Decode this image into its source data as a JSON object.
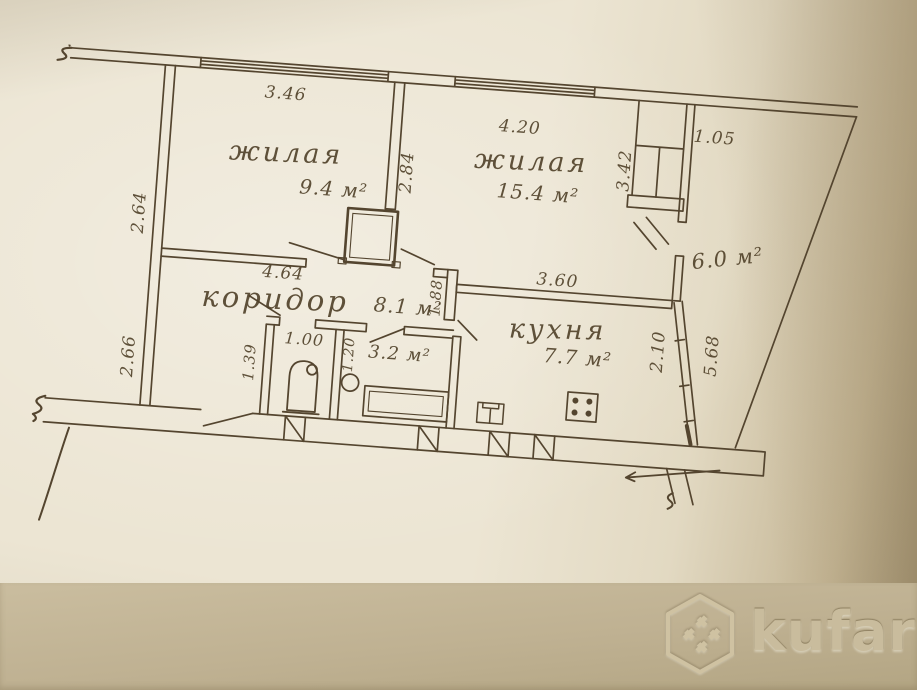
{
  "document_type": "apartment floor plan (hand-drawn, photographed)",
  "plan": {
    "rooms": {
      "living1": {
        "name": "жилая",
        "area": "9.4 м²"
      },
      "living2": {
        "name": "жилая",
        "area": "15.4 м²"
      },
      "corridor": {
        "name": "коридор",
        "area": "8.1 м²"
      },
      "kitchen": {
        "name": "кухня",
        "area": "7.7 м²"
      },
      "bathroom": {
        "area": "3.2 м²"
      },
      "balcony": {
        "area": "6.0 м²"
      }
    },
    "dimensions": {
      "room1_top": "3.46",
      "room2_top": "4.20",
      "closet_width": "1.05",
      "left_upper": "2.64",
      "left_lower": "2.66",
      "room1_side": "2.84",
      "closet_side": "3.42",
      "corridor_top": "4.64",
      "corridor_side": "1.88",
      "kitchen_top": "3.60",
      "toilet_top": "1.00",
      "toilet_side": "1.39",
      "bath_side": "1.20",
      "balcony_side_inner": "2.10",
      "balcony_side_outer": "5.68"
    },
    "ink_color": "#54452f",
    "paper_color": "#ece5d3"
  },
  "watermark": {
    "text": "kufar",
    "band_color": "#bfb192"
  }
}
